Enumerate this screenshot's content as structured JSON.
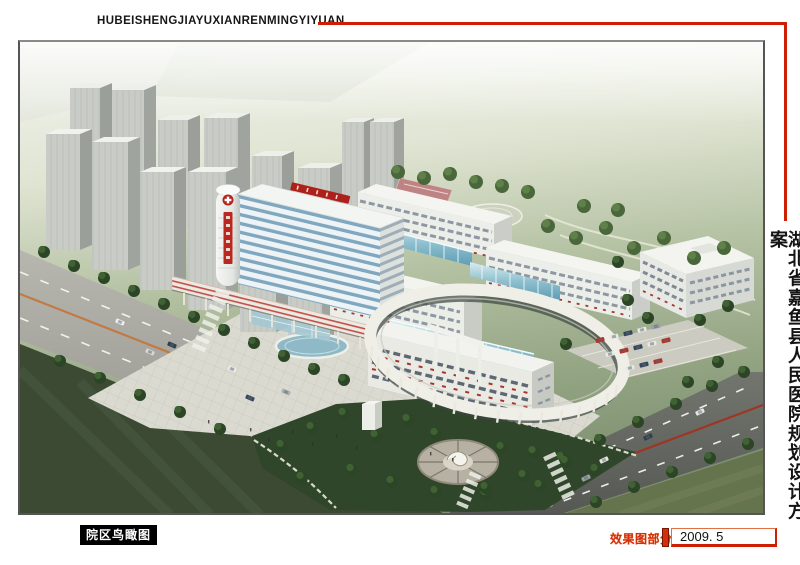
{
  "header": {
    "title_pinyin": "HUBEISHENGJIAYUXIANRENMINGYIYUAN"
  },
  "side_panel": {
    "title_cn": "湖北省嘉鱼县人民医院规划设计方案"
  },
  "rendering": {
    "caption": "院区鸟瞰图"
  },
  "footer": {
    "section_label": "效果图部分",
    "date": "2009. 5"
  },
  "colors": {
    "accent_red": "#cc1f04",
    "label_red": "#d2300a",
    "caption_bg": "#000000",
    "caption_text": "#ffffff",
    "frame_border": "#555555",
    "page_bg": "#ffffff"
  }
}
